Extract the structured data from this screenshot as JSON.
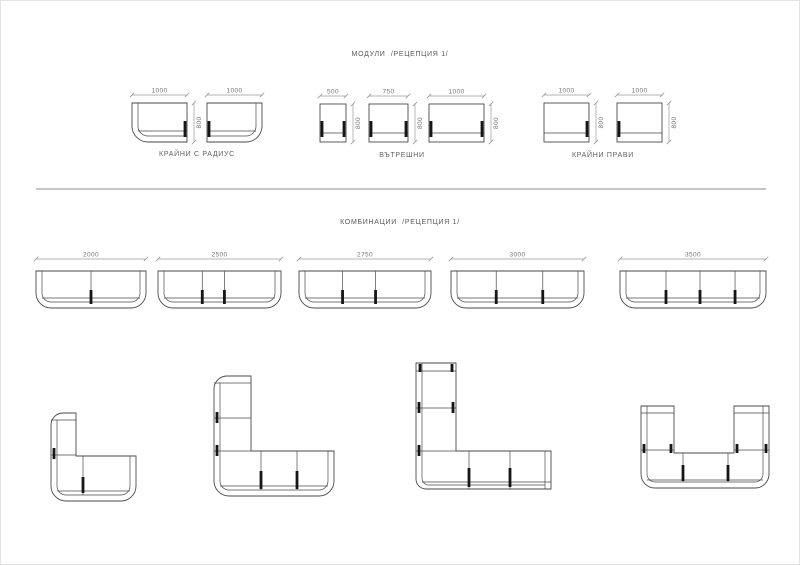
{
  "page": {
    "modules_title": "МОДУЛИ  /РЕЦЕПЦИЯ 1/",
    "combinations_title": "КОМБИНАЦИИ  /РЕЦЕПЦИЯ 1/"
  },
  "modules": {
    "groups": [
      {
        "label": "КРАЙНИ С РАДИУС",
        "height": "800",
        "items": [
          {
            "width": "1000",
            "type": "end-with-radius-left"
          },
          {
            "width": "1000",
            "type": "end-with-radius-right"
          }
        ]
      },
      {
        "label": "ВЪТРЕШНИ",
        "items": [
          {
            "width": "500",
            "height": "800",
            "type": "internal"
          },
          {
            "width": "750",
            "height": "800",
            "type": "internal"
          },
          {
            "width": "1000",
            "height": "800",
            "type": "internal"
          }
        ]
      },
      {
        "label": "КРАЙНИ ПРАВИ",
        "items": [
          {
            "width": "1000",
            "height": "800",
            "type": "end-straight-left"
          },
          {
            "width": "1000",
            "height": "800",
            "type": "end-straight-right"
          }
        ]
      }
    ]
  },
  "combinations": {
    "row1": [
      {
        "width": "2000"
      },
      {
        "width": "2500"
      },
      {
        "width": "2750"
      },
      {
        "width": "3000"
      },
      {
        "width": "3500"
      }
    ],
    "row2": [
      {
        "shape": "corner-L-low"
      },
      {
        "shape": "corner-L-high"
      },
      {
        "shape": "corner-L-straight-ends"
      },
      {
        "shape": "U-shape"
      }
    ]
  },
  "colors": {
    "line": "#4a4a4a",
    "accent_bar": "#161616",
    "dim_line": "#9a9a9a",
    "dim_text": "#757575",
    "label_text": "#616161",
    "divider": "#c6c6c6"
  }
}
